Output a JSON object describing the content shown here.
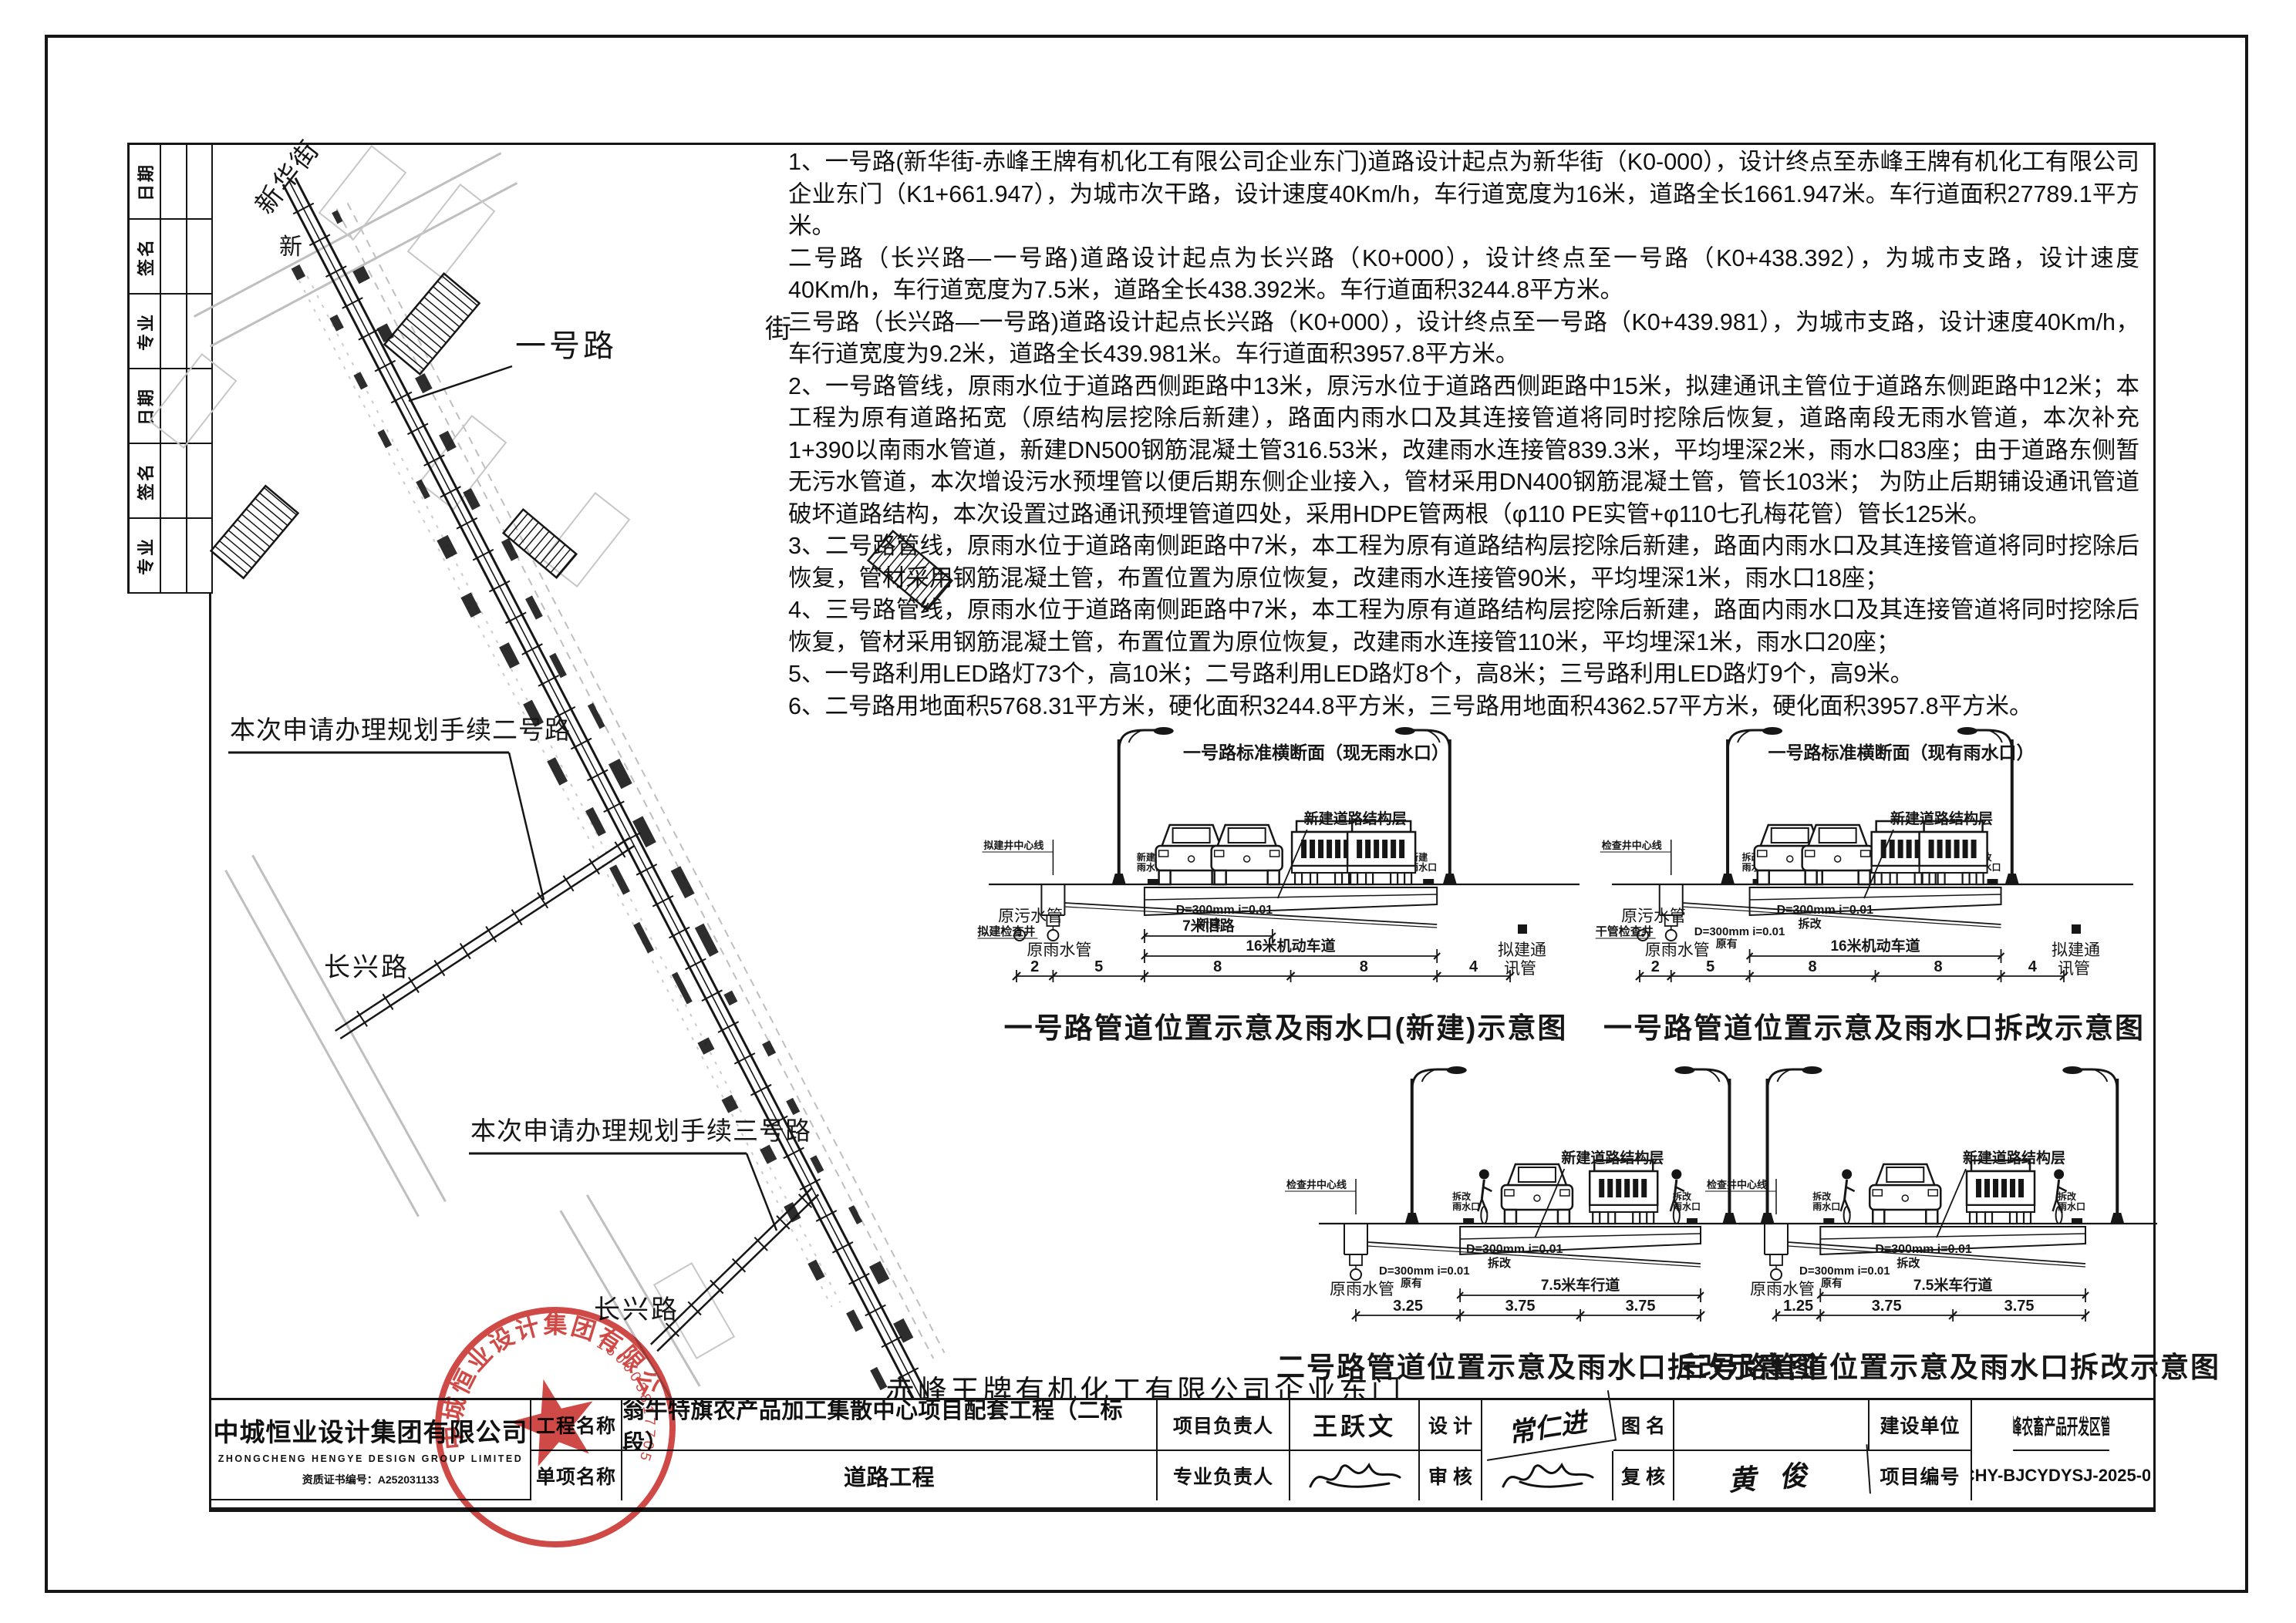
{
  "revision_strip": {
    "labels": [
      "日期",
      "签名",
      "专业",
      "日期",
      "签名",
      "专业"
    ]
  },
  "notes": [
    "1、一号路(新华街-赤峰王牌有机化工有限公司企业东门)道路设计起点为新华街（K0-000），设计终点至赤峰王牌有机化工有限公司企业东门（K1+661.947），为城市次干路，设计速度40Km/h，车行道宽度为16米，道路全长1661.947米。车行道面积27789.1平方米。",
    "二号路（长兴路—一号路)道路设计起点为长兴路（K0+000），设计终点至一号路（K0+438.392），为城市支路，设计速度40Km/h，车行道宽度为7.5米，道路全长438.392米。车行道面积3244.8平方米。",
    "三号路（长兴路—一号路)道路设计起点长兴路（K0+000），设计终点至一号路（K0+439.981），为城市支路，设计速度40Km/h，车行道宽度为9.2米，道路全长439.981米。车行道面积3957.8平方米。",
    "2、一号路管线，原雨水位于道路西侧距路中13米，原污水位于道路西侧距路中15米，拟建通讯主管位于道路东侧距路中12米；本工程为原有道路拓宽（原结构层挖除后新建），路面内雨水口及其连接管道将同时挖除后恢复，道路南段无雨水管道，本次补充1+390以南雨水管道，新建DN500钢筋混凝土管316.53米，改建雨水连接管839.3米，平均埋深2米，雨水口83座；由于道路东侧暂无污水管道，本次增设污水预埋管以便后期东侧企业接入，管材采用DN400钢筋混凝土管，管长103米； 为防止后期铺设通讯管道破坏道路结构，本次设置过路通讯预埋管道四处，采用HDPE管两根（φ110 PE实管+φ110七孔梅花管）管长125米。",
    "3、二号路管线，原雨水位于道路南侧距路中7米，本工程为原有道路结构层挖除后新建，路面内雨水口及其连接管道将同时挖除后恢复，管材采用钢筋混凝土管，布置位置为原位恢复，改建雨水连接管90米，平均埋深1米，雨水口18座；",
    "4、三号路管线，原雨水位于道路南侧距路中7米，本工程为原有道路结构层挖除后新建，路面内雨水口及其连接管道将同时挖除后恢复，管材采用钢筋混凝土管，布置位置为原位恢复，改建雨水连接管110米，平均埋深1米，雨水口20座；",
    "5、一号路利用LED路灯73个，高10米；二号路利用LED路灯8个，高8米；三号路利用LED路灯9个，高9米。",
    "6、二号路用地面积5768.31平方米，硬化面积3244.8平方米，三号路用地面积4362.57平方米，硬化面积3957.8平方米。"
  ],
  "plan": {
    "labels": {
      "street_top": "新华街",
      "street_char_left": "新",
      "street_char_right": "街",
      "road1": "一号路",
      "road2_callout": "本次申请办理规划手续二号路",
      "changxing_1": "长兴路",
      "road3_callout": "本次申请办理规划手续三号路",
      "changxing_2": "长兴路",
      "factory_gate": "赤峰王牌有机化工有限公司企业东门"
    }
  },
  "sections": [
    {
      "header": "一号路标准横断面（现无雨水口）",
      "title": "一号路管道位置示意及雨水口(新建)示意图",
      "sewer_label": "原污水管",
      "rain_label": "原雨水管",
      "comm_label": "拟建通讯管",
      "structure_label": "新建道路结构层",
      "inlet_label": "新建雨水口",
      "well_label": "拟建检查井",
      "centerline_label": "拟建井中心线",
      "pipe_note": "D=300mm i=0.01",
      "pipe_note_sub": "新建",
      "second_note": "",
      "second_note_sub": "",
      "dims": [
        "2",
        "5",
        "8",
        "8",
        "4"
      ],
      "bracket1": "7米旧路",
      "bracket2": "16米机动车道"
    },
    {
      "header": "一号路标准横断面（现有雨水口）",
      "title": "一号路管道位置示意及雨水口拆改示意图",
      "sewer_label": "原污水管",
      "rain_label": "原雨水管",
      "comm_label": "拟建通讯管",
      "structure_label": "新建道路结构层",
      "inlet_label": "拆改雨水口",
      "well_label": "干管检查井",
      "centerline_label": "检查井中心线",
      "pipe_note": "D=300mm i=0.01",
      "pipe_note_sub": "拆改",
      "second_note": "D=300mm i=0.01",
      "second_note_sub": "原有",
      "dims": [
        "2",
        "5",
        "8",
        "8",
        "4"
      ],
      "bracket1": "",
      "bracket2": "16米机动车道"
    },
    {
      "header": "",
      "title": "二号路管道位置示意及雨水口拆改示意图",
      "sewer_label": "",
      "rain_label": "原雨水管",
      "comm_label": "",
      "structure_label": "新建道路结构层",
      "inlet_label": "拆改雨水口",
      "well_label": "",
      "centerline_label": "检查井中心线",
      "pipe_note": "D=300mm i=0.01",
      "pipe_note_sub": "拆改",
      "second_note": "D=300mm i=0.01",
      "second_note_sub": "原有",
      "dims": [
        "3.25",
        "3.75",
        "3.75"
      ],
      "bracket1": "",
      "bracket2": "7.5米车行道"
    },
    {
      "header": "",
      "title": "三号路管道位置示意及雨水口拆改示意图",
      "sewer_label": "",
      "rain_label": "原雨水管",
      "comm_label": "",
      "structure_label": "新建道路结构层",
      "inlet_label": "拆改雨水口",
      "well_label": "",
      "centerline_label": "检查井中心线",
      "pipe_note": "D=300mm i=0.01",
      "pipe_note_sub": "拆改",
      "second_note": "D=300mm i=0.01",
      "second_note_sub": "原有",
      "dims": [
        "1.25",
        "3.75",
        "3.75"
      ],
      "bracket1": "",
      "bracket2": "7.5米车行道"
    }
  ],
  "title_block": {
    "company_cn": "中城恒业设计集团有限公司",
    "company_en": "ZHONGCHENG HENGYE DESIGN GROUP LIMITED",
    "cert_no": "资质证书编号：A252031133",
    "row1": {
      "label": "工程名称",
      "content": "翁牛特旗农产品加工集散中心项目配套工程（二标段）",
      "role": "项目负责人",
      "person": "王跃文",
      "stage": "设 计",
      "sign": "常仁进",
      "fig_label": "图 名",
      "fig_value": "",
      "unit_label": "建设单位",
      "unit_value": "内蒙古赤峰农畜产品开发区管理委员会"
    },
    "row2": {
      "label": "单项名称",
      "content": "道路工程",
      "role": "专业负责人",
      "person": "",
      "stage": "审 核",
      "sign": "",
      "fig_label": "复 核",
      "fig_value": "黄 俊",
      "unit_label": "项目编号",
      "unit_value": "ZCHY-BJCYDYSJ-2025-001"
    }
  },
  "stamp": {
    "company": "中城恒业设计集团有限公司",
    "number": "150003817705"
  }
}
